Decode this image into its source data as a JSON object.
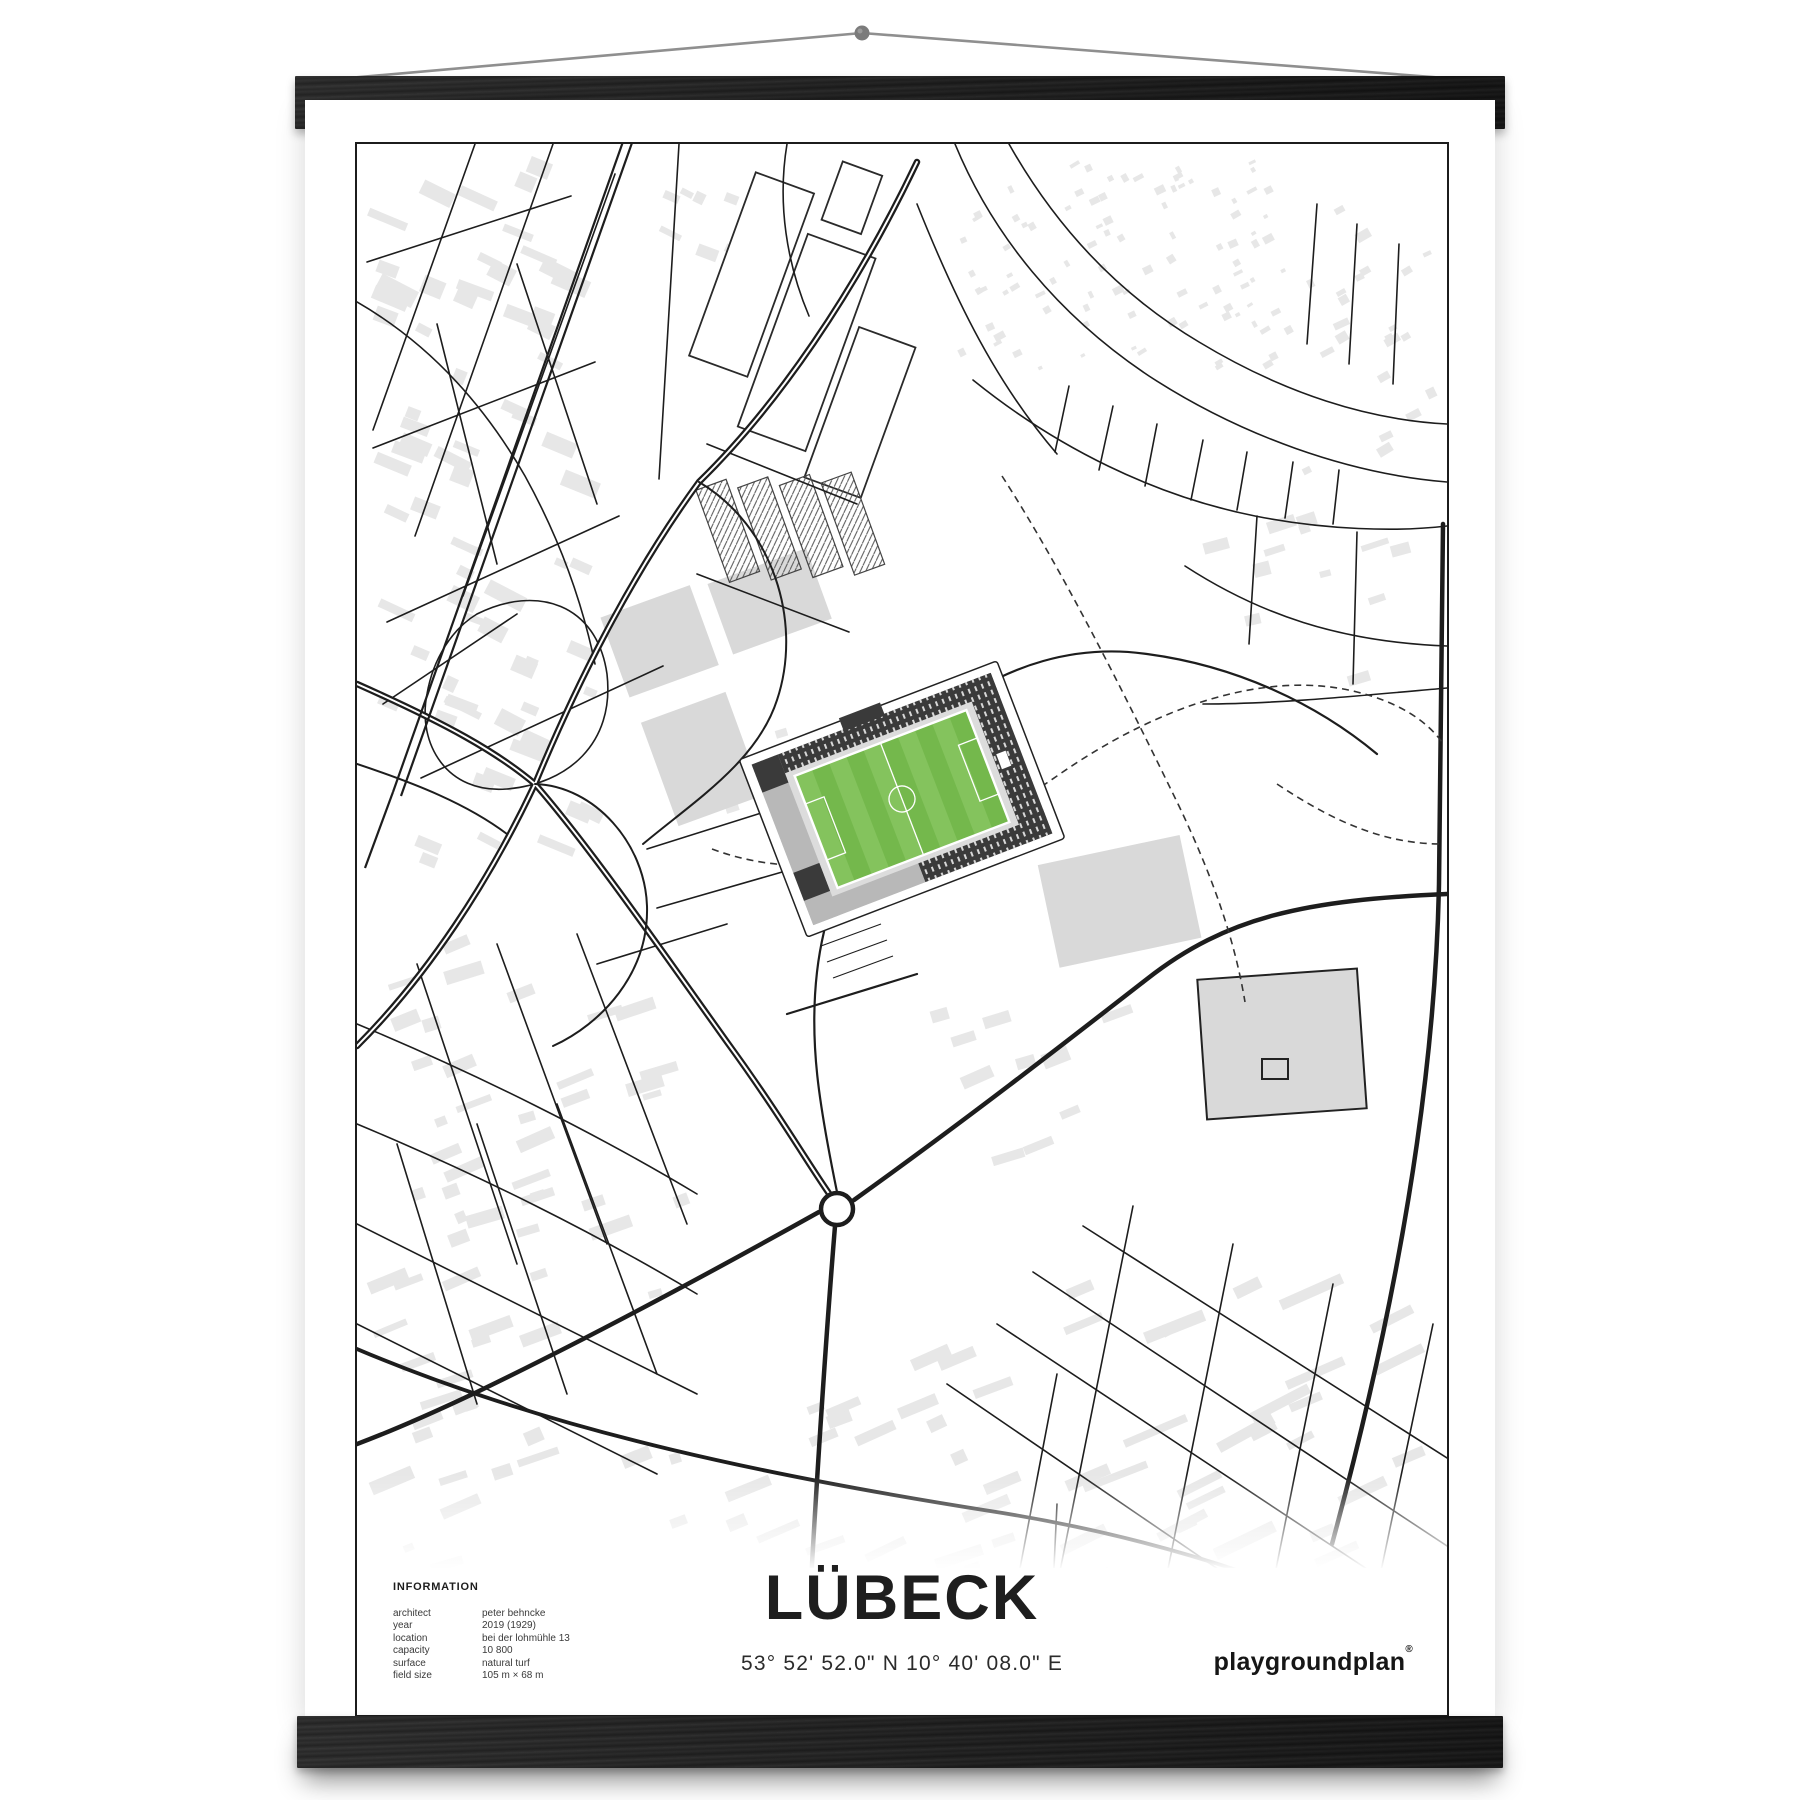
{
  "poster": {
    "title": "LÜBECK",
    "coordinates": "53° 52' 52.0\" N 10° 40' 08.0\" E",
    "brand": {
      "name": "playgroundplan",
      "mark": "®"
    },
    "information": {
      "heading": "INFORMATION",
      "rows": [
        {
          "label": "architect",
          "value": "peter behncke"
        },
        {
          "label": "year",
          "value": "2019 (1929)"
        },
        {
          "label": "location",
          "value": "bei der lohmühle 13"
        },
        {
          "label": "capacity",
          "value": "10 800"
        },
        {
          "label": "surface",
          "value": "natural turf"
        },
        {
          "label": "field size",
          "value": "105 m × 68 m"
        }
      ]
    }
  },
  "map": {
    "colors": {
      "building": "#e7e7e7",
      "building_dark": "#d9d9d9",
      "road": "#1d1d1d",
      "stand_dark": "#3a3a3a",
      "pitch_stripe_light": "#84c35d",
      "pitch_stripe_dark": "#74b84c",
      "hanger_bar": "#1f1f1f",
      "string": "#8f8f8f",
      "paper": "#ffffff"
    }
  }
}
